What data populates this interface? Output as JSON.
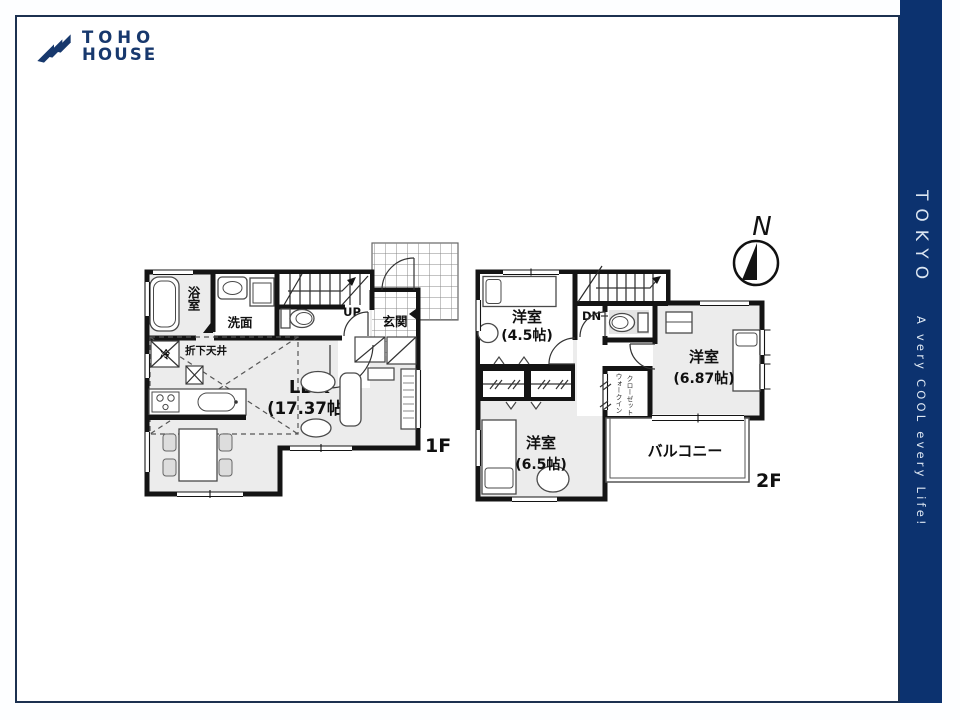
{
  "colors": {
    "sidebar_bg": "#0c326f",
    "logo_navy": "#17386d",
    "wall": "#141414",
    "room_fill": "#ececec",
    "frame_border": "#1c3150",
    "sidebar_text": "#dce6f2"
  },
  "logo": {
    "line1": "TOHO",
    "line2": "HOUSE"
  },
  "sidebar": {
    "title": "TOKYO",
    "tagline": "A very COOL every Life!"
  },
  "compass": {
    "north": "N"
  },
  "plan1f": {
    "floor": "1F",
    "bath": "浴室",
    "wash": "洗面",
    "entrance": "玄関",
    "up": "UP",
    "lowered_ceiling": "折下天井",
    "fridge": "冷",
    "ldk": "LDK",
    "ldk_size": "(17.37帖)"
  },
  "plan2f": {
    "floor": "2F",
    "dn": "DN",
    "room1": "洋室",
    "room1_size": "(4.5帖)",
    "room2": "洋室",
    "room2_size": "(6.87帖)",
    "room3": "洋室",
    "room3_size": "(6.5帖)",
    "wic1": "ウォークイン",
    "wic2": "クローゼット",
    "balcony": "バルコニー"
  }
}
